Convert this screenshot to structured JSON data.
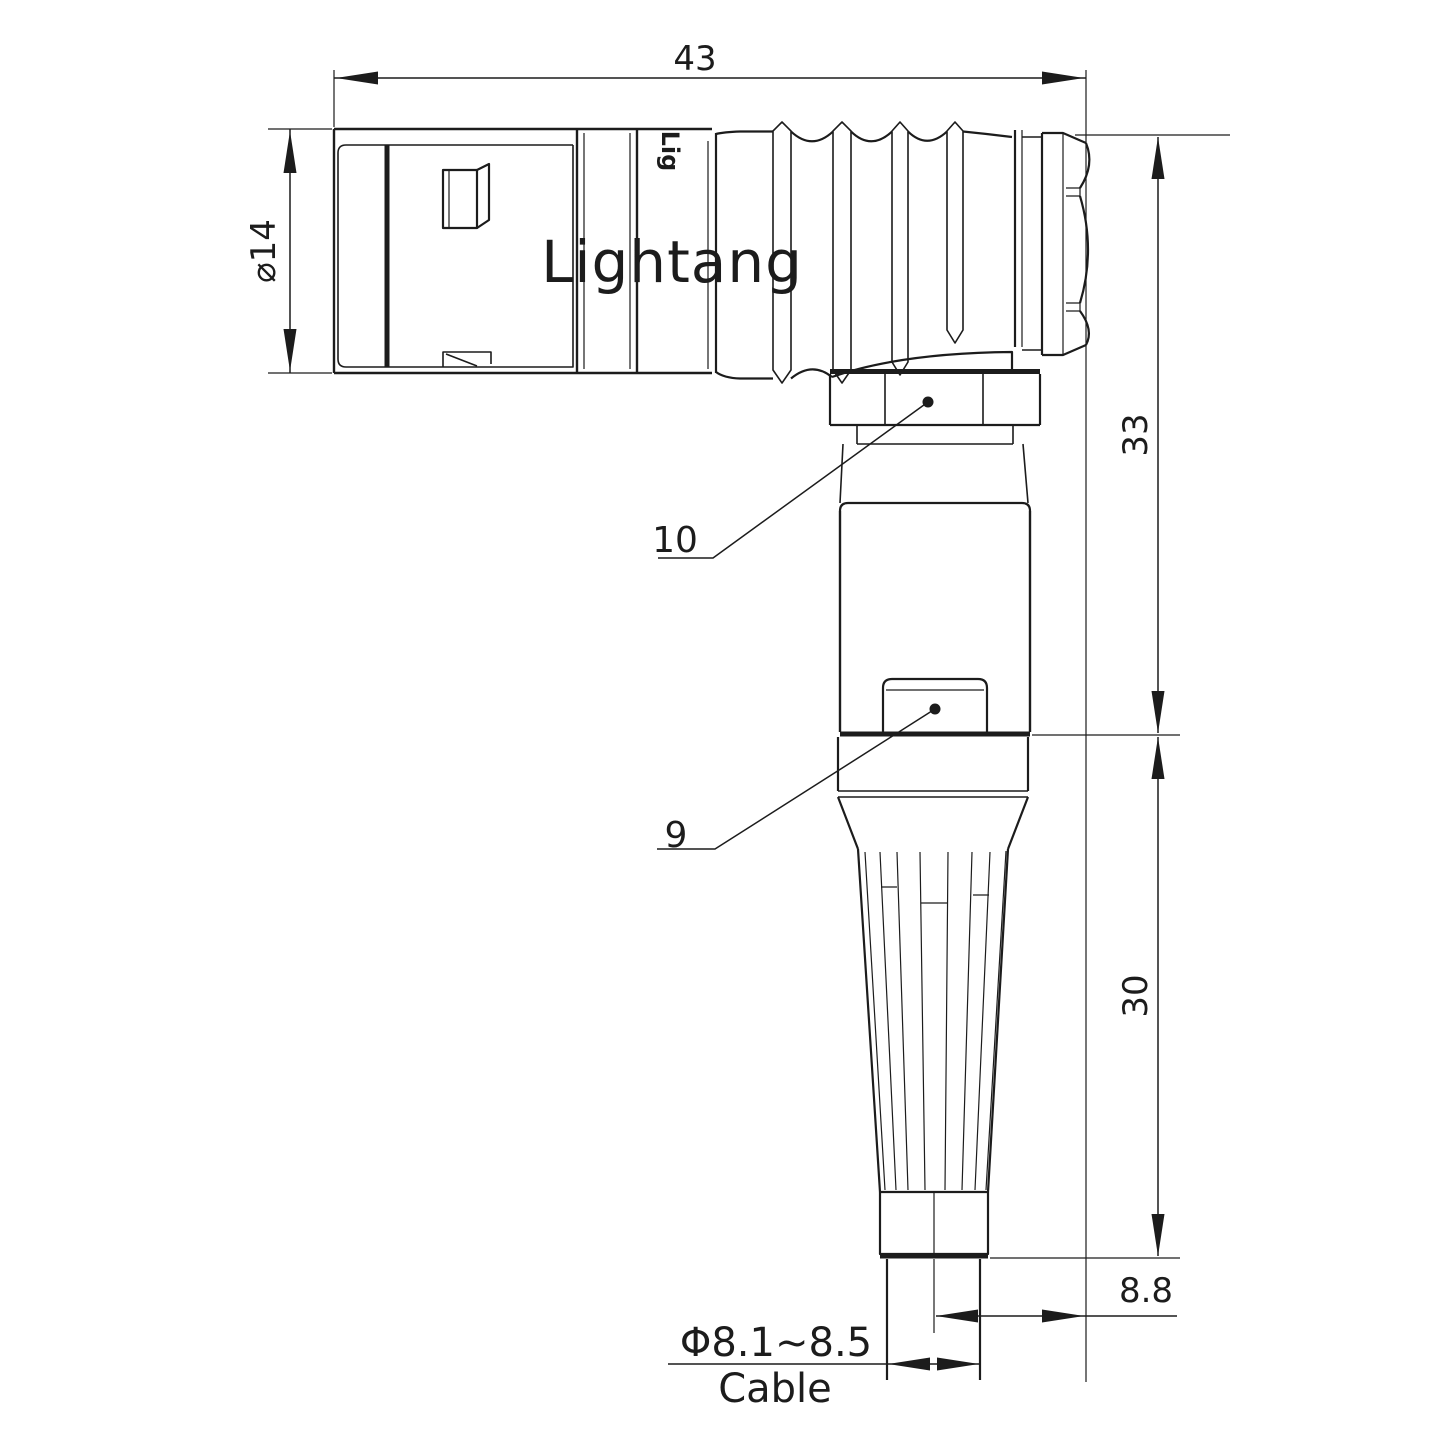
{
  "watermark": {
    "text": "Lightang",
    "color": "#f2cdcd"
  },
  "body_logo": "Lig",
  "labels": {
    "length_top": "43",
    "diameter_left": "⌀14",
    "height_upper": "33",
    "height_lower": "30",
    "offset": "8.8",
    "cable_diameter": "Φ8.1~8.5",
    "cable": "Cable"
  },
  "callouts": {
    "hex_nut": "10",
    "cable_clamp": "9"
  },
  "colors": {
    "line": "#1c1c1c",
    "background": "#ffffff"
  }
}
